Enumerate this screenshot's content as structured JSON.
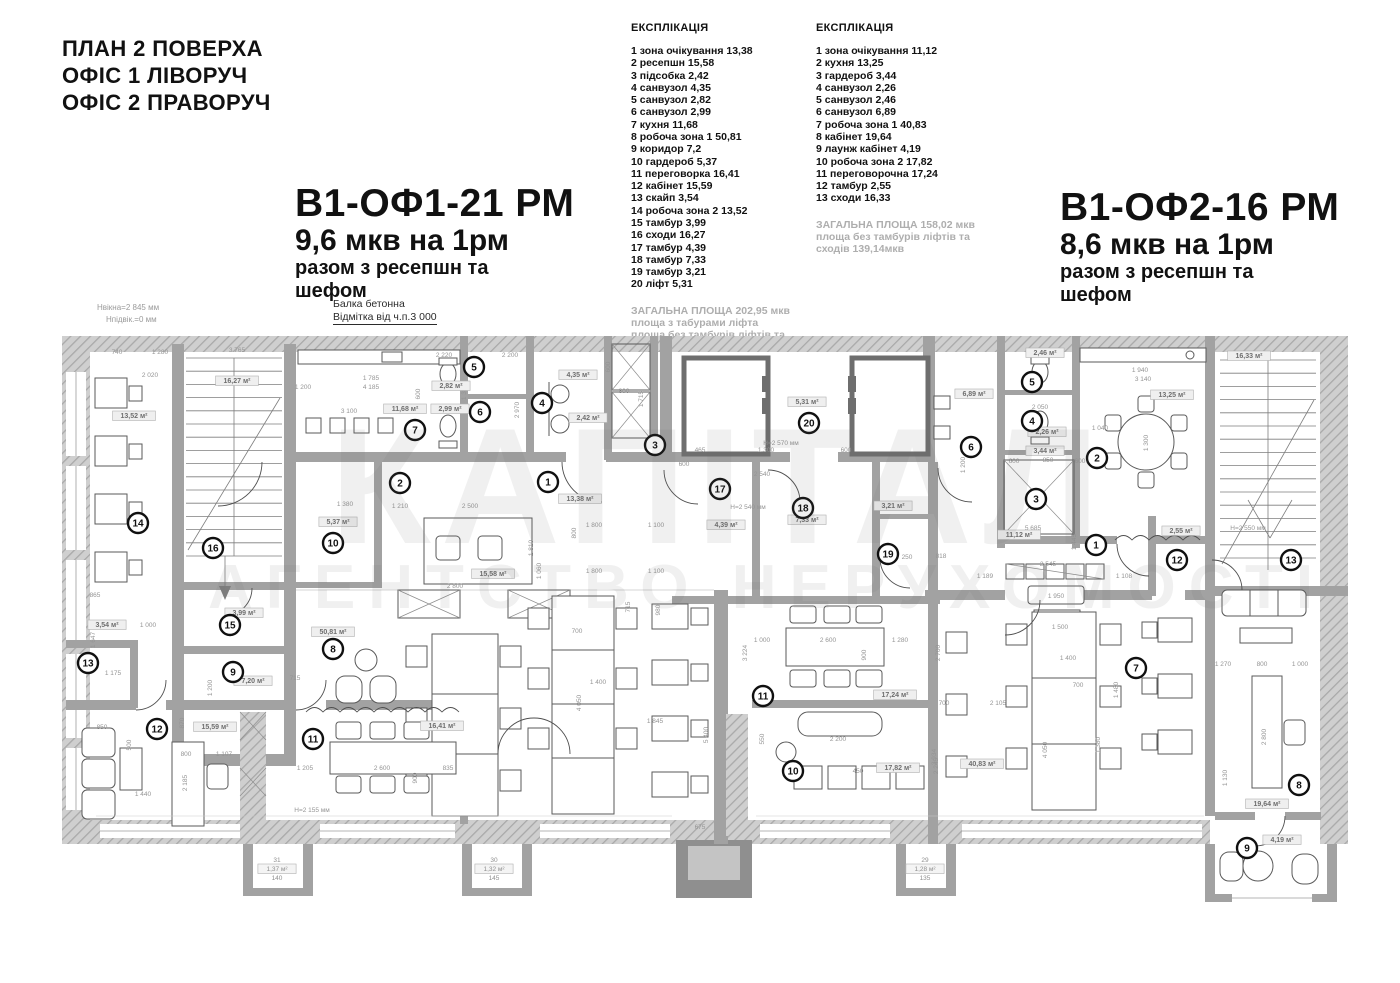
{
  "header": {
    "plan_title": "ПЛАН 2 ПОВЕРХА\nОФІС 1 ЛІВОРУЧ\nОФІС 2 ПРАВОРУЧ",
    "annotations": {
      "window_height": "Нвікна=2 845 мм",
      "sill_height": "Нпідвік.=0 мм",
      "beam_line1": "Балка бетонна",
      "beam_line2": "Відмітка від ч.п.3 000"
    }
  },
  "office1": {
    "title": "В1-ОФ1-21 РМ",
    "subtitle": "9,6 мкв на 1рм",
    "note_line1": "разом з ресепшн та",
    "note_line2": "шефом"
  },
  "office2": {
    "title": "В1-ОФ2-16 РМ",
    "subtitle": "8,6 мкв на 1рм",
    "note_line1": "разом з ресепшн та",
    "note_line2": "шефом"
  },
  "legend_left": {
    "title": "ЕКСПЛІКАЦІЯ",
    "items": [
      "1 зона очікування 13,38",
      "2 ресепшн 15,58",
      "3 підсобка 2,42",
      "4 санвузол 4,35",
      "5 санвузол 2,82",
      "6 санвузол 2,99",
      "7 кухня 11,68",
      "8 робоча зона 1 50,81",
      "9 коридор 7,2",
      "10 гардероб 5,37",
      "11 переговорка 16,41",
      "12 кабінет 15,59",
      "13 скайп 3,54",
      "14 робоча зона 2 13,52",
      "15 тамбур 3,99",
      "16 сходи 16,27",
      "17 тамбур 4,39",
      "18 тамбур 7,33",
      "19 тамбур 3,21",
      "20 ліфт 5,31"
    ],
    "totals": [
      "ЗАГАЛЬНА ПЛОЩА 202,95 мкв",
      "площа з табурами ліфта",
      "площа без тамбурів ліфтів та",
      "сходів 161,5мкв"
    ]
  },
  "legend_right": {
    "title": "ЕКСПЛІКАЦІЯ",
    "items": [
      "1 зона очікування 11,12",
      "2 кухня 13,25",
      "3 гардероб 3,44",
      "4 санвузол 2,26",
      "5 санвузол 2,46",
      "6 санвузол 6,89",
      "7 робоча зона 1 40,83",
      "8 кабінет 19,64",
      "9  лаунж кабінет 4,19",
      "10 робоча зона 2 17,82",
      "11 переговорочна 17,24",
      "12 тамбур 2,55",
      "13 сходи 16,33"
    ],
    "totals": [
      "ЗАГАЛЬНА ПЛОЩА 158,02 мкв",
      "площа без тамбурів ліфтів та",
      "сходів 139,14мкв"
    ]
  },
  "watermark": {
    "line1": "КАПІТАЛ",
    "line2": "АГЕНТСТВО НЕРУХОМОСТІ"
  },
  "plan": {
    "markers_office1": [
      {
        "n": "1",
        "x": 548,
        "y": 482
      },
      {
        "n": "2",
        "x": 400,
        "y": 483
      },
      {
        "n": "3",
        "x": 655,
        "y": 445
      },
      {
        "n": "4",
        "x": 542,
        "y": 403
      },
      {
        "n": "5",
        "x": 474,
        "y": 367
      },
      {
        "n": "6",
        "x": 480,
        "y": 412
      },
      {
        "n": "7",
        "x": 415,
        "y": 430
      },
      {
        "n": "8",
        "x": 333,
        "y": 649
      },
      {
        "n": "9",
        "x": 233,
        "y": 672
      },
      {
        "n": "10",
        "x": 333,
        "y": 543
      },
      {
        "n": "11",
        "x": 313,
        "y": 739
      },
      {
        "n": "12",
        "x": 157,
        "y": 729
      },
      {
        "n": "13",
        "x": 88,
        "y": 663
      },
      {
        "n": "14",
        "x": 138,
        "y": 523
      },
      {
        "n": "15",
        "x": 230,
        "y": 625
      },
      {
        "n": "16",
        "x": 213,
        "y": 548
      },
      {
        "n": "17",
        "x": 720,
        "y": 489
      },
      {
        "n": "18",
        "x": 803,
        "y": 508
      },
      {
        "n": "19",
        "x": 888,
        "y": 554
      },
      {
        "n": "20",
        "x": 809,
        "y": 423
      }
    ],
    "markers_office2": [
      {
        "n": "1",
        "x": 1096,
        "y": 545
      },
      {
        "n": "2",
        "x": 1097,
        "y": 458
      },
      {
        "n": "3",
        "x": 1036,
        "y": 499
      },
      {
        "n": "4",
        "x": 1032,
        "y": 421
      },
      {
        "n": "5",
        "x": 1032,
        "y": 382
      },
      {
        "n": "6",
        "x": 971,
        "y": 447
      },
      {
        "n": "7",
        "x": 1136,
        "y": 668
      },
      {
        "n": "8",
        "x": 1299,
        "y": 785
      },
      {
        "n": "9",
        "x": 1247,
        "y": 848
      },
      {
        "n": "10",
        "x": 793,
        "y": 771
      },
      {
        "n": "11",
        "x": 763,
        "y": 696
      },
      {
        "n": "12",
        "x": 1177,
        "y": 560
      },
      {
        "n": "13",
        "x": 1291,
        "y": 560
      }
    ],
    "area_labels": [
      {
        "t": "16,27 м²",
        "x": 237,
        "y": 383
      },
      {
        "t": "13,52 м²",
        "x": 134,
        "y": 418
      },
      {
        "t": "11,68 м²",
        "x": 405,
        "y": 411
      },
      {
        "t": "2,82 м²",
        "x": 451,
        "y": 388
      },
      {
        "t": "2,99 м²",
        "x": 450,
        "y": 411
      },
      {
        "t": "4,35 м²",
        "x": 578,
        "y": 377
      },
      {
        "t": "2,42 м²",
        "x": 588,
        "y": 420
      },
      {
        "t": "5,31 м²",
        "x": 807,
        "y": 404
      },
      {
        "t": "13,38 м²",
        "x": 580,
        "y": 501
      },
      {
        "t": "15,58 м²",
        "x": 493,
        "y": 576
      },
      {
        "t": "5,37 м²",
        "x": 338,
        "y": 524
      },
      {
        "t": "3,99 м²",
        "x": 244,
        "y": 615
      },
      {
        "t": "50,81 м²",
        "x": 333,
        "y": 634
      },
      {
        "t": "7,20 м²",
        "x": 253,
        "y": 683
      },
      {
        "t": "15,59 м²",
        "x": 215,
        "y": 729
      },
      {
        "t": "16,41 м²",
        "x": 442,
        "y": 728
      },
      {
        "t": "3,54 м²",
        "x": 107,
        "y": 627
      },
      {
        "t": "4,39 м²",
        "x": 726,
        "y": 527
      },
      {
        "t": "7,33 м²",
        "x": 807,
        "y": 522
      },
      {
        "t": "3,21 м²",
        "x": 893,
        "y": 508
      },
      {
        "t": "2,46 м²",
        "x": 1045,
        "y": 355
      },
      {
        "t": "6,89 м²",
        "x": 974,
        "y": 396
      },
      {
        "t": "2,26 м²",
        "x": 1047,
        "y": 434
      },
      {
        "t": "3,44 м²",
        "x": 1045,
        "y": 453
      },
      {
        "t": "13,25 м²",
        "x": 1172,
        "y": 397
      },
      {
        "t": "16,33 м²",
        "x": 1249,
        "y": 358
      },
      {
        "t": "11,12 м²",
        "x": 1019,
        "y": 537
      },
      {
        "t": "2,55 м²",
        "x": 1181,
        "y": 533
      },
      {
        "t": "17,24 м²",
        "x": 895,
        "y": 697
      },
      {
        "t": "17,82 м²",
        "x": 898,
        "y": 770
      },
      {
        "t": "40,83 м²",
        "x": 982,
        "y": 766
      },
      {
        "t": "19,64 м²",
        "x": 1267,
        "y": 806
      },
      {
        "t": "4,19 м²",
        "x": 1282,
        "y": 842
      }
    ],
    "balcony_labels": [
      {
        "lines": [
          "31",
          "1,37 м²",
          "140"
        ],
        "x": 277,
        "y": 862
      },
      {
        "lines": [
          "30",
          "1,32 м²",
          "145"
        ],
        "x": 494,
        "y": 862
      },
      {
        "lines": [
          "29",
          "1,28 м²",
          "135"
        ],
        "x": 925,
        "y": 862
      }
    ],
    "dims": [
      {
        "t": "740",
        "x": 117,
        "y": 354
      },
      {
        "t": "1 280",
        "x": 160,
        "y": 354
      },
      {
        "t": "3 765",
        "x": 237,
        "y": 352
      },
      {
        "t": "2 020",
        "x": 150,
        "y": 377
      },
      {
        "t": "1 200",
        "x": 303,
        "y": 389
      },
      {
        "t": "1 785",
        "x": 371,
        "y": 380
      },
      {
        "t": "4 185",
        "x": 371,
        "y": 389
      },
      {
        "t": "3 100",
        "x": 349,
        "y": 413
      },
      {
        "t": "2 220",
        "x": 444,
        "y": 357
      },
      {
        "t": "2 200",
        "x": 510,
        "y": 357
      },
      {
        "t": "1 357",
        "x": 466,
        "y": 392,
        "r": 1
      },
      {
        "t": "2 970",
        "x": 519,
        "y": 410,
        "r": 1
      },
      {
        "t": "600",
        "x": 420,
        "y": 394,
        "r": 1
      },
      {
        "t": "800",
        "x": 624,
        "y": 393
      },
      {
        "t": "1 715",
        "x": 643,
        "y": 399,
        "r": 1
      },
      {
        "t": "600",
        "x": 610,
        "y": 367,
        "r": 1
      },
      {
        "t": "H=2 570 мм",
        "x": 781,
        "y": 445
      },
      {
        "t": "1 300",
        "x": 766,
        "y": 452
      },
      {
        "t": "600",
        "x": 846,
        "y": 452
      },
      {
        "t": "465",
        "x": 700,
        "y": 452
      },
      {
        "t": "H=2 540 мм",
        "x": 748,
        "y": 509
      },
      {
        "t": "600",
        "x": 684,
        "y": 466
      },
      {
        "t": "2 540",
        "x": 762,
        "y": 476
      },
      {
        "t": "3 224",
        "x": 747,
        "y": 653,
        "r": 1
      },
      {
        "t": "980",
        "x": 660,
        "y": 610,
        "r": 1
      },
      {
        "t": "5 400",
        "x": 708,
        "y": 735,
        "r": 1
      },
      {
        "t": "1 000",
        "x": 762,
        "y": 642
      },
      {
        "t": "2 600",
        "x": 828,
        "y": 642
      },
      {
        "t": "1 280",
        "x": 900,
        "y": 642
      },
      {
        "t": "900",
        "x": 866,
        "y": 655,
        "r": 1
      },
      {
        "t": "2 200",
        "x": 838,
        "y": 741
      },
      {
        "t": "550",
        "x": 764,
        "y": 739,
        "r": 1
      },
      {
        "t": "450",
        "x": 858,
        "y": 773
      },
      {
        "t": "250",
        "x": 907,
        "y": 559
      },
      {
        "t": "818",
        "x": 941,
        "y": 558
      },
      {
        "t": "1 189",
        "x": 985,
        "y": 578
      },
      {
        "t": "5 685",
        "x": 1033,
        "y": 530
      },
      {
        "t": "1 445",
        "x": 1076,
        "y": 542,
        "r": 1
      },
      {
        "t": "2 545",
        "x": 1048,
        "y": 566
      },
      {
        "t": "1 108",
        "x": 1124,
        "y": 578
      },
      {
        "t": "1 950",
        "x": 1056,
        "y": 598
      },
      {
        "t": "1 500",
        "x": 1060,
        "y": 629
      },
      {
        "t": "H=2 550 мм",
        "x": 1248,
        "y": 530
      },
      {
        "t": "1 200",
        "x": 965,
        "y": 465,
        "r": 1
      },
      {
        "t": "1 940",
        "x": 1140,
        "y": 372
      },
      {
        "t": "3 140",
        "x": 1143,
        "y": 381
      },
      {
        "t": "1 040",
        "x": 1100,
        "y": 430
      },
      {
        "t": "1 300",
        "x": 1148,
        "y": 443,
        "r": 1
      },
      {
        "t": "2 050",
        "x": 1040,
        "y": 409
      },
      {
        "t": "850",
        "x": 1048,
        "y": 462
      },
      {
        "t": "600",
        "x": 1014,
        "y": 463
      },
      {
        "t": "600",
        "x": 1080,
        "y": 463
      },
      {
        "t": "1 270",
        "x": 1223,
        "y": 666
      },
      {
        "t": "800",
        "x": 1262,
        "y": 666
      },
      {
        "t": "1 000",
        "x": 1300,
        "y": 666
      },
      {
        "t": "2 800",
        "x": 1266,
        "y": 737,
        "r": 1
      },
      {
        "t": "3 934",
        "x": 936,
        "y": 757,
        "r": 1
      },
      {
        "t": "2 105",
        "x": 998,
        "y": 705
      },
      {
        "t": "700",
        "x": 1078,
        "y": 687
      },
      {
        "t": "1 400",
        "x": 1068,
        "y": 660
      },
      {
        "t": "4 050",
        "x": 1047,
        "y": 750,
        "r": 1
      },
      {
        "t": "1 380",
        "x": 1100,
        "y": 745,
        "r": 1
      },
      {
        "t": "2 700",
        "x": 940,
        "y": 653,
        "r": 1
      },
      {
        "t": "2 245",
        "x": 938,
        "y": 766,
        "r": 1
      },
      {
        "t": "700",
        "x": 944,
        "y": 705
      },
      {
        "t": "1 200",
        "x": 212,
        "y": 688,
        "r": 1
      },
      {
        "t": "850",
        "x": 102,
        "y": 729
      },
      {
        "t": "500",
        "x": 131,
        "y": 745,
        "r": 1
      },
      {
        "t": "870",
        "x": 184,
        "y": 723,
        "r": 1
      },
      {
        "t": "800",
        "x": 186,
        "y": 756
      },
      {
        "t": "1 107",
        "x": 224,
        "y": 756
      },
      {
        "t": "2 185",
        "x": 187,
        "y": 783,
        "r": 1
      },
      {
        "t": "1 440",
        "x": 143,
        "y": 796
      },
      {
        "t": "1 205",
        "x": 305,
        "y": 770
      },
      {
        "t": "2 600",
        "x": 382,
        "y": 770
      },
      {
        "t": "900",
        "x": 417,
        "y": 778,
        "r": 1
      },
      {
        "t": "835",
        "x": 448,
        "y": 770
      },
      {
        "t": "1 210",
        "x": 400,
        "y": 508
      },
      {
        "t": "2 500",
        "x": 470,
        "y": 508
      },
      {
        "t": "1 380",
        "x": 345,
        "y": 506
      },
      {
        "t": "1 810",
        "x": 533,
        "y": 548,
        "r": 1
      },
      {
        "t": "800",
        "x": 576,
        "y": 533,
        "r": 1
      },
      {
        "t": "1 800",
        "x": 594,
        "y": 527
      },
      {
        "t": "1 100",
        "x": 656,
        "y": 527
      },
      {
        "t": "1 060",
        "x": 541,
        "y": 571,
        "r": 1
      },
      {
        "t": "1 800",
        "x": 594,
        "y": 573
      },
      {
        "t": "1 100",
        "x": 656,
        "y": 573
      },
      {
        "t": "2 800",
        "x": 455,
        "y": 588
      },
      {
        "t": "715",
        "x": 630,
        "y": 607,
        "r": 1
      },
      {
        "t": "1 400",
        "x": 598,
        "y": 684
      },
      {
        "t": "700",
        "x": 577,
        "y": 633
      },
      {
        "t": "4 050",
        "x": 581,
        "y": 703,
        "r": 1
      },
      {
        "t": "1 845",
        "x": 655,
        "y": 723
      },
      {
        "t": "H=2 155 мм",
        "x": 312,
        "y": 812
      },
      {
        "t": "675",
        "x": 700,
        "y": 829
      },
      {
        "t": "865",
        "x": 95,
        "y": 597
      },
      {
        "t": "1 175",
        "x": 113,
        "y": 675
      },
      {
        "t": "1 647",
        "x": 95,
        "y": 640,
        "r": 1
      },
      {
        "t": "1 000",
        "x": 148,
        "y": 627
      },
      {
        "t": "715",
        "x": 295,
        "y": 680
      },
      {
        "t": "1 480",
        "x": 1118,
        "y": 690,
        "r": 1
      },
      {
        "t": "1 130",
        "x": 1227,
        "y": 778,
        "r": 1
      }
    ]
  }
}
